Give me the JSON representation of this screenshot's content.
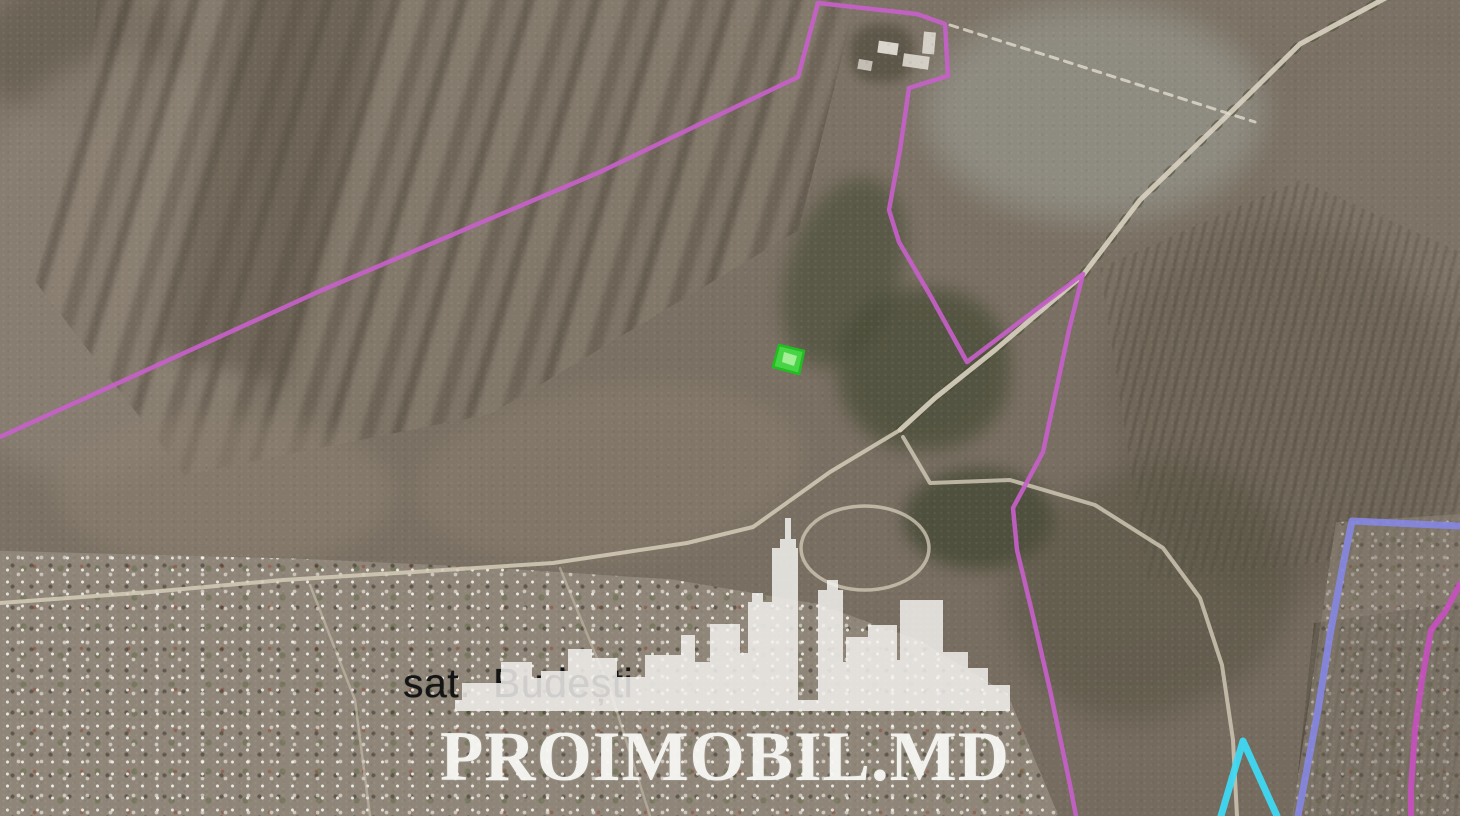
{
  "map": {
    "village_label": "sat. Budești",
    "watermark": {
      "text": "PROIMOBIL.MD",
      "logo": "city-skyline"
    }
  },
  "palette": {
    "boundary_magenta": "#c75fc9",
    "boundary_periwinkle": "#8587e2",
    "boundary_cyan": "#3ed9f2",
    "boundary_pink": "#c94fc0",
    "plot_green_fill": "#45db45",
    "plot_green_edge": "#1ec21e",
    "road": "#d9d1c1",
    "watermark_white": "#f3f2ef",
    "label_black": "#141414"
  },
  "overlays": {
    "roads": [
      {
        "name": "treeline-main-road",
        "color": "#454832",
        "width": 9,
        "opacity": 0.5,
        "dash": "4 18",
        "points": [
          [
            1393,
            -6
          ],
          [
            1300,
            44
          ],
          [
            1233,
            110
          ],
          [
            1140,
            200
          ],
          [
            1083,
            275
          ],
          [
            995,
            350
          ],
          [
            935,
            398
          ],
          [
            900,
            430
          ]
        ]
      },
      {
        "name": "road-main-ne",
        "color": "#d9d1c1",
        "width": 5,
        "opacity": 0.9,
        "points": [
          [
            1393,
            -6
          ],
          [
            1300,
            44
          ],
          [
            1233,
            110
          ],
          [
            1140,
            200
          ],
          [
            1083,
            275
          ],
          [
            995,
            350
          ],
          [
            935,
            398
          ],
          [
            900,
            430
          ]
        ]
      },
      {
        "name": "road-west-to-village",
        "color": "#d5ccb9",
        "width": 4,
        "opacity": 0.85,
        "points": [
          [
            900,
            430
          ],
          [
            830,
            472
          ],
          [
            753,
            527
          ],
          [
            687,
            543
          ],
          [
            553,
            563
          ],
          [
            413,
            572
          ],
          [
            283,
            580
          ],
          [
            150,
            592
          ],
          [
            0,
            603
          ]
        ]
      },
      {
        "name": "road-loop-southeast",
        "color": "#d5ccb9",
        "width": 4,
        "opacity": 0.8,
        "points": [
          [
            903,
            437
          ],
          [
            930,
            483
          ],
          [
            1010,
            480
          ],
          [
            1095,
            505
          ],
          [
            1163,
            548
          ],
          [
            1200,
            598
          ],
          [
            1222,
            665
          ],
          [
            1233,
            740
          ],
          [
            1237,
            816
          ]
        ]
      },
      {
        "name": "road-roundabout",
        "type": "ellipse",
        "color": "#d5ccb9",
        "width": 3.5,
        "opacity": 0.75,
        "cx": 865,
        "cy": 548,
        "rx": 64,
        "ry": 42
      },
      {
        "name": "road-farm-track-dashed",
        "color": "#e2dccd",
        "width": 3,
        "opacity": 0.8,
        "dash": "8 7",
        "points": [
          [
            950,
            25
          ],
          [
            1080,
            66
          ],
          [
            1255,
            122
          ]
        ]
      },
      {
        "name": "road-village-street-a",
        "color": "#cfc6b4",
        "width": 2.5,
        "opacity": 0.55,
        "points": [
          [
            310,
            585
          ],
          [
            355,
            700
          ],
          [
            370,
            816
          ]
        ]
      },
      {
        "name": "road-village-street-b",
        "color": "#cfc6b4",
        "width": 2.5,
        "opacity": 0.5,
        "points": [
          [
            560,
            568
          ],
          [
            610,
            690
          ],
          [
            650,
            816
          ]
        ]
      }
    ],
    "boundaries": [
      {
        "name": "boundary-main-magenta",
        "color": "#c75fc9",
        "width": 4.5,
        "opacity": 0.92,
        "points": [
          [
            0,
            437
          ],
          [
            320,
            291
          ],
          [
            600,
            172
          ],
          [
            798,
            77
          ],
          [
            818,
            3
          ],
          [
            917,
            14
          ],
          [
            945,
            24
          ],
          [
            948,
            76
          ],
          [
            909,
            88
          ],
          [
            900,
            150
          ],
          [
            889,
            210
          ],
          [
            899,
            242
          ],
          [
            930,
            295
          ],
          [
            967,
            362
          ],
          [
            1083,
            274
          ],
          [
            1069,
            330
          ],
          [
            1043,
            452
          ],
          [
            1013,
            508
          ],
          [
            1017,
            550
          ],
          [
            1032,
            612
          ],
          [
            1050,
            690
          ],
          [
            1070,
            785
          ],
          [
            1076,
            816
          ]
        ]
      },
      {
        "name": "boundary-periwinkle",
        "color": "#8587e2",
        "width": 7,
        "opacity": 0.92,
        "points": [
          [
            1460,
            526
          ],
          [
            1352,
            521
          ],
          [
            1343,
            565
          ],
          [
            1330,
            635
          ],
          [
            1318,
            710
          ],
          [
            1298,
            816
          ]
        ]
      },
      {
        "name": "boundary-cyan",
        "color": "#3ed9f2",
        "width": 7,
        "opacity": 0.95,
        "points": [
          [
            1221,
            816
          ],
          [
            1243,
            741
          ],
          [
            1277,
            816
          ]
        ]
      },
      {
        "name": "boundary-pink-east",
        "color": "#c94fc0",
        "width": 6,
        "opacity": 0.9,
        "points": [
          [
            1460,
            584
          ],
          [
            1445,
            612
          ],
          [
            1431,
            630
          ],
          [
            1422,
            680
          ],
          [
            1415,
            730
          ],
          [
            1411,
            790
          ],
          [
            1411,
            816
          ]
        ]
      }
    ],
    "plot": {
      "name": "selected-plot-green",
      "fill": "#45db45",
      "stroke": "#1ec21e",
      "width": 2.5,
      "opacity": 0.95,
      "points": [
        [
          779,
          345
        ],
        [
          804,
          351
        ],
        [
          799,
          374
        ],
        [
          773,
          367
        ]
      ],
      "inner": {
        "name": "selected-plot-highlight",
        "fill": "#b4f2a6",
        "opacity": 0.85,
        "points": [
          [
            784,
            352
          ],
          [
            797,
            356
          ],
          [
            794,
            366
          ],
          [
            782,
            362
          ]
        ]
      }
    }
  }
}
